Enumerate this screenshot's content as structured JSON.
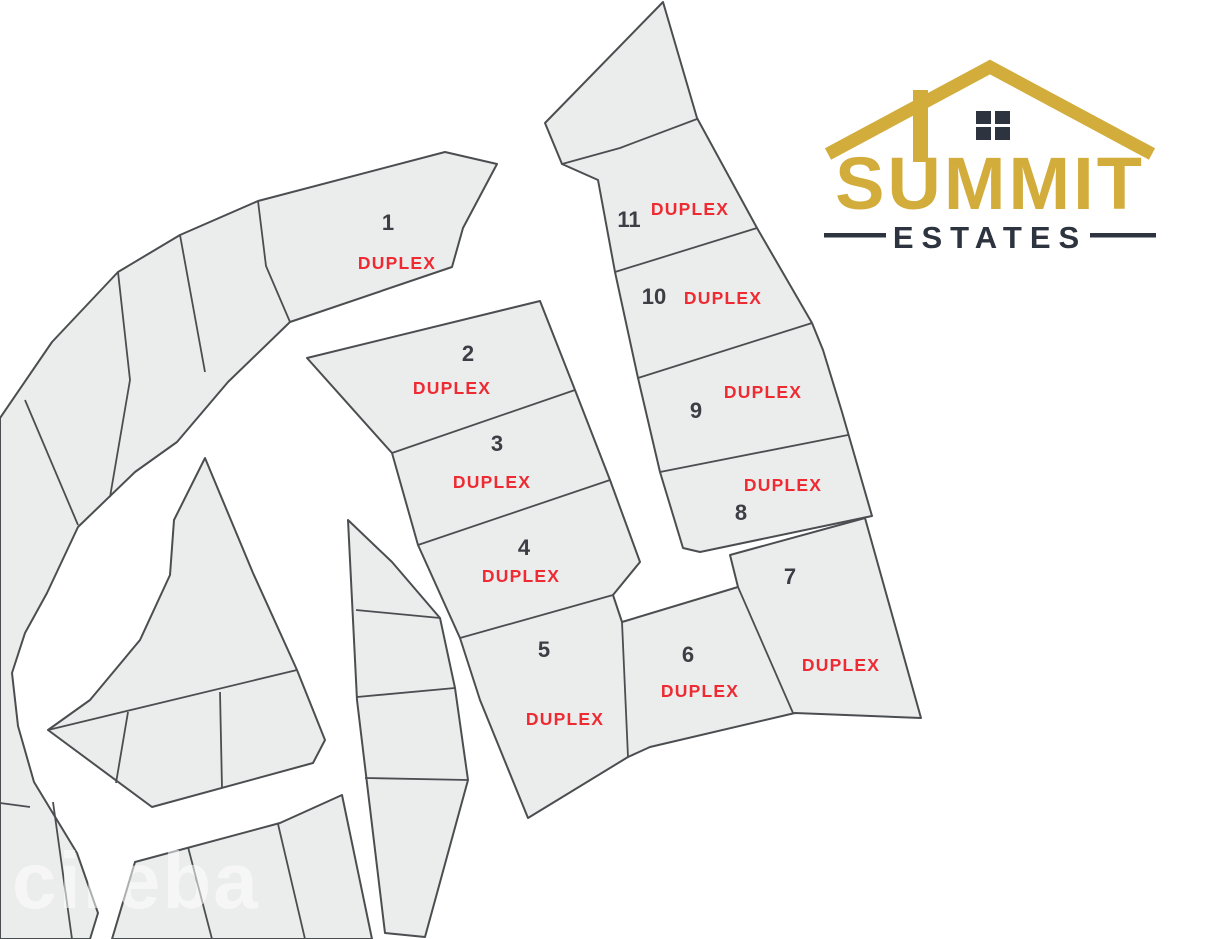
{
  "brand": {
    "name": "SUMMIT",
    "subtitle": "ESTATES"
  },
  "map": {
    "lots": [
      {
        "number": "1",
        "type": "DUPLEX"
      },
      {
        "number": "2",
        "type": "DUPLEX"
      },
      {
        "number": "3",
        "type": "DUPLEX"
      },
      {
        "number": "4",
        "type": "DUPLEX"
      },
      {
        "number": "5",
        "type": "DUPLEX"
      },
      {
        "number": "6",
        "type": "DUPLEX"
      },
      {
        "number": "7",
        "type": "DUPLEX"
      },
      {
        "number": "8",
        "type": "DUPLEX"
      },
      {
        "number": "9",
        "type": "DUPLEX"
      },
      {
        "number": "10",
        "type": "DUPLEX"
      },
      {
        "number": "11",
        "type": "DUPLEX"
      }
    ]
  },
  "watermark": {
    "text": "cireba"
  },
  "colors": {
    "lot_fill": "#ebecec",
    "lot_border": "#4b4e50",
    "duplex_red": "#ee2b33",
    "number_dark": "#3b3e44",
    "brand_gold": "#d3ad3b",
    "brand_dark": "#2d3440",
    "background": "#ffffff"
  }
}
